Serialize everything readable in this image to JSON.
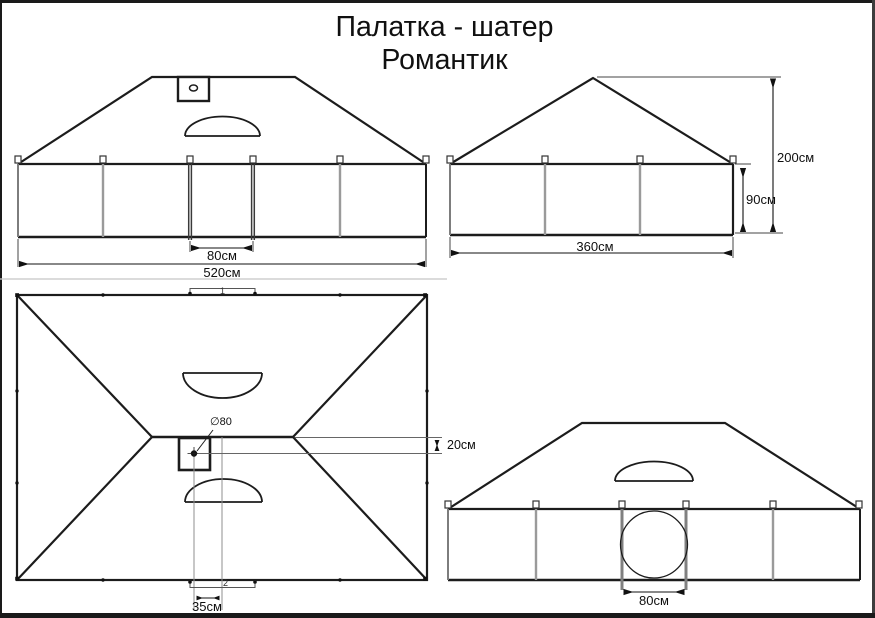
{
  "title": {
    "line1": "Палатка - шатер",
    "line2": "Романтик"
  },
  "front_view": {
    "door_width_label": "80см",
    "total_width_label": "520см"
  },
  "side_view": {
    "width_label": "360см",
    "wall_height_label": "90см",
    "total_height_label": "200см"
  },
  "plan_view": {
    "hole_label": "∅80",
    "ridge_offset_label": "20см",
    "hole_offset_label": "35см",
    "marker_top": "1",
    "marker_bottom": "2"
  },
  "rear_view": {
    "window_width_label": "80см"
  },
  "colors": {
    "line": "#1c1c1c",
    "light_line": "#9a9a9a",
    "text": "#0f0f0f"
  }
}
